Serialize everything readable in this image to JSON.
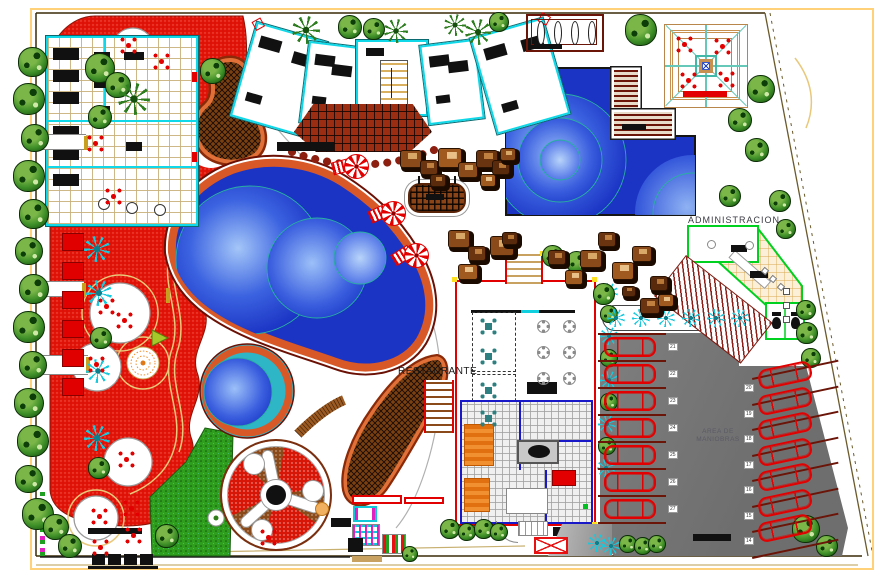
{
  "labels": {
    "administration": "ADMINISTRACION",
    "restaurant": "RESTAURANTE",
    "maneuver_area_line1": "AREA DE",
    "maneuver_area_line2": "MANIOBRAS"
  },
  "parking": {
    "left_stall_numbers": [
      "21",
      "22",
      "23",
      "24",
      "25",
      "26",
      "27"
    ],
    "right_stall_numbers": [
      "20",
      "19",
      "18",
      "17",
      "16",
      "15",
      "14"
    ],
    "left_cars": {
      "x": 604,
      "y0": 337,
      "dy": 27,
      "w": 52,
      "h": 20,
      "count": 7
    },
    "right_cars": {
      "x": 758,
      "y0": 365,
      "dy": 25.5,
      "w": 54,
      "h": 20,
      "rot": -12,
      "count": 7
    }
  },
  "colors": {
    "plaza_red": "#e31407",
    "water_blue": "#1b34c4",
    "rim_orange": "#d85828",
    "tree_green": "#2e7d1f",
    "palm_cyan": "#18c8dc",
    "car_red": "#e20000",
    "admin_green": "#00d020",
    "restaurant_red": "#e20000",
    "boundary_yellow": "#ffd27a",
    "parking_gray": "#9a9a9a",
    "terrace_brown": "#9b2d12",
    "rock_brown": "#8a4a1a"
  },
  "trees": [
    [
      33,
      62,
      15,
      "g"
    ],
    [
      29,
      99,
      16,
      "g"
    ],
    [
      35,
      138,
      14,
      "g"
    ],
    [
      29,
      176,
      16,
      "g"
    ],
    [
      34,
      214,
      15,
      "g"
    ],
    [
      29,
      251,
      14,
      "g"
    ],
    [
      34,
      289,
      15,
      "g"
    ],
    [
      29,
      327,
      16,
      "g"
    ],
    [
      33,
      365,
      14,
      "g"
    ],
    [
      29,
      403,
      15,
      "g"
    ],
    [
      33,
      441,
      16,
      "g"
    ],
    [
      29,
      479,
      14,
      "g"
    ],
    [
      38,
      514,
      16,
      "g"
    ],
    [
      56,
      527,
      13,
      "g"
    ],
    [
      70,
      546,
      12,
      "g"
    ],
    [
      100,
      68,
      15,
      "g"
    ],
    [
      118,
      85,
      13,
      "g"
    ],
    [
      134,
      99,
      16,
      "p"
    ],
    [
      100,
      117,
      12,
      "g"
    ],
    [
      97,
      249,
      13,
      "c"
    ],
    [
      99,
      293,
      13,
      "c"
    ],
    [
      101,
      338,
      11,
      "g"
    ],
    [
      98,
      371,
      12,
      "c"
    ],
    [
      97,
      438,
      13,
      "c"
    ],
    [
      99,
      468,
      11,
      "g"
    ],
    [
      213,
      71,
      13,
      "g"
    ],
    [
      306,
      30,
      14,
      "p"
    ],
    [
      350,
      27,
      12,
      "g"
    ],
    [
      374,
      29,
      11,
      "g"
    ],
    [
      396,
      31,
      12,
      "p"
    ],
    [
      455,
      25,
      11,
      "p"
    ],
    [
      478,
      32,
      13,
      "p"
    ],
    [
      499,
      22,
      10,
      "g"
    ],
    [
      641,
      30,
      16,
      "g"
    ],
    [
      761,
      89,
      14,
      "g"
    ],
    [
      740,
      120,
      12,
      "g"
    ],
    [
      757,
      150,
      12,
      "g"
    ],
    [
      730,
      196,
      11,
      "g"
    ],
    [
      780,
      201,
      11,
      "g"
    ],
    [
      786,
      229,
      10,
      "g"
    ],
    [
      806,
      310,
      10,
      "g"
    ],
    [
      807,
      333,
      11,
      "g"
    ],
    [
      811,
      358,
      10,
      "g"
    ],
    [
      806,
      529,
      14,
      "g"
    ],
    [
      827,
      546,
      11,
      "g"
    ],
    [
      609,
      292,
      9,
      "c"
    ],
    [
      609,
      314,
      9,
      "g"
    ],
    [
      609,
      336,
      9,
      "c"
    ],
    [
      609,
      358,
      9,
      "g"
    ],
    [
      609,
      380,
      9,
      "c"
    ],
    [
      609,
      402,
      9,
      "g"
    ],
    [
      607,
      424,
      9,
      "c"
    ],
    [
      607,
      446,
      9,
      "g"
    ],
    [
      606,
      468,
      9,
      "c"
    ],
    [
      553,
      256,
      11,
      "g"
    ],
    [
      577,
      262,
      11,
      "g"
    ],
    [
      604,
      294,
      11,
      "g"
    ],
    [
      616,
      318,
      9,
      "c"
    ],
    [
      641,
      318,
      9,
      "c"
    ],
    [
      666,
      318,
      9,
      "c"
    ],
    [
      691,
      318,
      9,
      "c"
    ],
    [
      716,
      318,
      9,
      "c"
    ],
    [
      740,
      318,
      9,
      "c"
    ],
    [
      450,
      529,
      10,
      "g"
    ],
    [
      467,
      532,
      9,
      "g"
    ],
    [
      484,
      529,
      10,
      "g"
    ],
    [
      499,
      532,
      9,
      "g"
    ],
    [
      597,
      543,
      9,
      "c"
    ],
    [
      611,
      546,
      9,
      "c"
    ],
    [
      628,
      544,
      9,
      "g"
    ],
    [
      643,
      546,
      9,
      "g"
    ],
    [
      657,
      544,
      9,
      "g"
    ],
    [
      167,
      536,
      12,
      "g"
    ],
    [
      410,
      554,
      8,
      "g"
    ]
  ],
  "plaza_tables": [
    [
      128,
      45
    ],
    [
      161,
      61
    ],
    [
      95,
      143
    ],
    [
      113,
      196
    ],
    [
      106,
      306
    ],
    [
      124,
      320
    ],
    [
      96,
      364
    ],
    [
      126,
      459
    ],
    [
      99,
      516
    ],
    [
      131,
      508
    ],
    [
      100,
      547
    ],
    [
      133,
      535
    ],
    [
      268,
      537
    ]
  ],
  "pergola_tables": [
    [
      684,
      44
    ],
    [
      722,
      46
    ],
    [
      688,
      80
    ],
    [
      726,
      79
    ]
  ],
  "restaurant_tables": {
    "teal": [
      [
        488,
        326
      ],
      [
        488,
        356
      ],
      [
        488,
        390
      ],
      [
        488,
        418
      ]
    ],
    "round": [
      [
        543,
        326
      ],
      [
        569,
        326
      ],
      [
        543,
        352
      ],
      [
        569,
        352
      ],
      [
        543,
        378
      ],
      [
        569,
        378
      ]
    ]
  },
  "umbrellas": [
    {
      "x": 356,
      "y": 166,
      "rot": -15
    },
    {
      "x": 393,
      "y": 213,
      "rot": -25
    },
    {
      "x": 416,
      "y": 255,
      "rot": -32
    }
  ],
  "sunbeds": [
    [
      62,
      233
    ],
    [
      62,
      262
    ],
    [
      62,
      291
    ],
    [
      62,
      320
    ],
    [
      62,
      349
    ],
    [
      62,
      378
    ]
  ],
  "rocks": [
    [
      400,
      150,
      22,
      0
    ],
    [
      420,
      160,
      18,
      1
    ],
    [
      438,
      148,
      24,
      2
    ],
    [
      458,
      162,
      20,
      0
    ],
    [
      476,
      150,
      22,
      1
    ],
    [
      492,
      160,
      18,
      3
    ],
    [
      480,
      174,
      16,
      2
    ],
    [
      430,
      174,
      16,
      3
    ],
    [
      500,
      148,
      16,
      0
    ],
    [
      448,
      230,
      22,
      0
    ],
    [
      468,
      246,
      18,
      1
    ],
    [
      458,
      264,
      20,
      2
    ],
    [
      490,
      236,
      24,
      0
    ],
    [
      502,
      232,
      16,
      3
    ],
    [
      548,
      250,
      18,
      1
    ],
    [
      565,
      270,
      18,
      2
    ],
    [
      580,
      250,
      22,
      0
    ],
    [
      598,
      232,
      18,
      1
    ],
    [
      612,
      262,
      22,
      2
    ],
    [
      632,
      246,
      20,
      0
    ],
    [
      650,
      276,
      18,
      3
    ],
    [
      640,
      298,
      20,
      1
    ],
    [
      658,
      294,
      16,
      2
    ],
    [
      622,
      286,
      14,
      3
    ]
  ]
}
